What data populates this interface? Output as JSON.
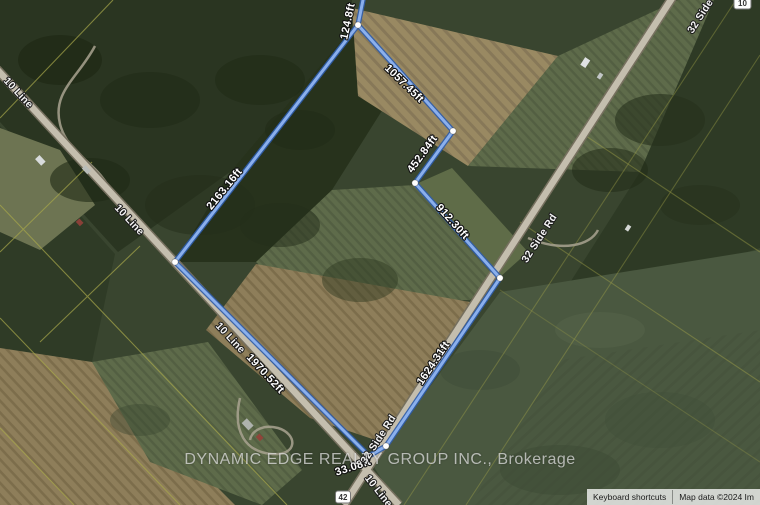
{
  "watermark_text": "DYNAMIC EDGE REALTY GROUP INC., Brokerage",
  "attribution": {
    "keyboard_shortcuts": "Keyboard shortcuts",
    "map_data": "Map data ©2024 Im"
  },
  "boundary": {
    "segment_labels": [
      "124.8ft",
      "1057.45ft",
      "452.84ft",
      "912.30ft",
      "1624.31ft",
      "33.08ft",
      "1970.52ft",
      "2163.16ft"
    ]
  },
  "roads": {
    "labels": [
      "10 Line",
      "10 Line",
      "10 Line",
      "32 Side Rd",
      "32 Side",
      "32 Side Rd",
      "10 Line"
    ],
    "shields": [
      "42",
      "10"
    ]
  },
  "colors": {
    "boundary_outer": "#2d5cab",
    "boundary_inner": "#8fb4f0",
    "vertex_dot": "#ffffff",
    "parcel_line": "#a8a84b",
    "road": "#c4beae"
  }
}
